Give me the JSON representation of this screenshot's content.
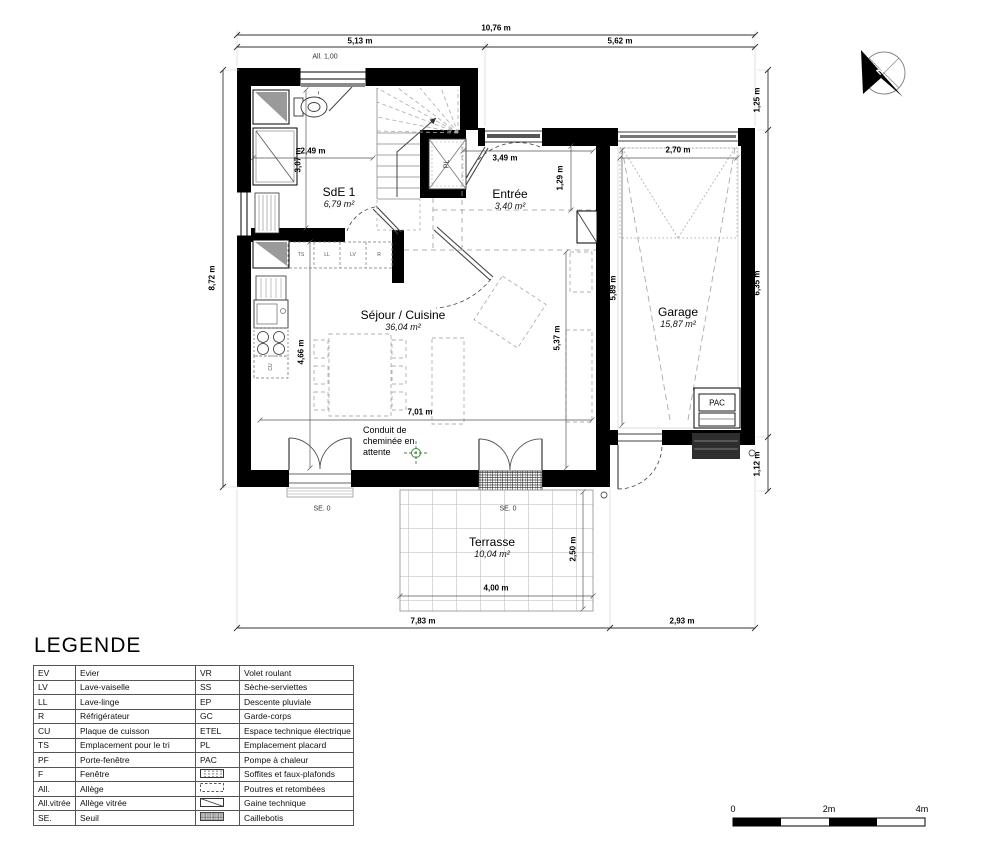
{
  "dimensions": {
    "top_total": "10,76 m",
    "top_left": "5,13 m",
    "top_right": "5,62 m",
    "left_total": "8,72 m",
    "right_top": "1,25 m",
    "right_middle": "6,35 m",
    "right_bottom": "1,12 m",
    "bottom_left": "7,83 m",
    "bottom_right": "2,93 m",
    "sde_width": "2,49 m",
    "sde_height": "3,07 m",
    "entree_width": "3,49 m",
    "entree_height": "1,29 m",
    "sejour_width": "7,01 m",
    "sejour_height": "4,66 m",
    "sejour_height2": "5,37 m",
    "garage_width": "2,70 m",
    "garage_height": "5,89 m",
    "terrasse_width": "4,00 m",
    "terrasse_height": "2,50 m"
  },
  "rooms": {
    "sde": {
      "name": "SdE 1",
      "area": "6,79 m²"
    },
    "entree": {
      "name": "Entrée",
      "area": "3,40 m²"
    },
    "sejour": {
      "name": "Séjour / Cuisine",
      "area": "36,04 m²"
    },
    "garage": {
      "name": "Garage",
      "area": "15,87 m²"
    },
    "terrasse": {
      "name": "Terrasse",
      "area": "10,04 m²"
    }
  },
  "annotations": {
    "allege_window": "All. 1,00",
    "seuil_left": "SE. 0",
    "seuil_right": "SE. 0",
    "placard": "PL",
    "pac": "PAC",
    "hob": "CU",
    "chimney_note": [
      "Conduit de",
      "cheminée en",
      "attente"
    ],
    "counter_units": [
      "TS",
      "LL",
      "LV",
      "R"
    ]
  },
  "legend": {
    "title": "LEGENDE",
    "rows": [
      {
        "l_abbr": "EV",
        "l_desc": "Evier",
        "r_abbr": "VR",
        "r_desc": "Volet roulant"
      },
      {
        "l_abbr": "LV",
        "l_desc": "Lave-vaiselle",
        "r_abbr": "SS",
        "r_desc": "Sèche-serviettes"
      },
      {
        "l_abbr": "LL",
        "l_desc": "Lave-linge",
        "r_abbr": "EP",
        "r_desc": "Descente pluviale"
      },
      {
        "l_abbr": "R",
        "l_desc": "Réfrigérateur",
        "r_abbr": "GC",
        "r_desc": "Garde-corps"
      },
      {
        "l_abbr": "CU",
        "l_desc": "Plaque de cuisson",
        "r_abbr": "ETEL",
        "r_desc": "Espace technique électrique"
      },
      {
        "l_abbr": "TS",
        "l_desc": "Emplacement pour le tri",
        "r_abbr": "PL",
        "r_desc": "Emplacement placard"
      },
      {
        "l_abbr": "PF",
        "l_desc": "Porte-fenêtre",
        "r_abbr": "PAC",
        "r_desc": "Pompe à chaleur"
      },
      {
        "l_abbr": "F",
        "l_desc": "Fenêtre",
        "r_abbr": "",
        "r_icon": "soffites-pattern-icon",
        "r_desc": "Soffites et faux-plafonds"
      },
      {
        "l_abbr": "All.",
        "l_desc": "Allège",
        "r_abbr": "",
        "r_icon": "poutres-pattern-icon",
        "r_desc": "Poutres et retombées"
      },
      {
        "l_abbr": "All.vitrée",
        "l_desc": "Allège vitrée",
        "r_abbr": "",
        "r_icon": "gaine-pattern-icon",
        "r_desc": "Gaine technique"
      },
      {
        "l_abbr": "SE.",
        "l_desc": "Seuil",
        "r_abbr": "",
        "r_icon": "caillebotis-pattern-icon",
        "r_desc": "Caillebotis"
      }
    ]
  },
  "scalebar": {
    "zero": "0",
    "two": "2m",
    "four": "4m"
  },
  "compass": {
    "north": "N"
  },
  "colors": {
    "wall": "#000000",
    "dashed": "#999999",
    "chimney_green": "#3a8a3a"
  }
}
